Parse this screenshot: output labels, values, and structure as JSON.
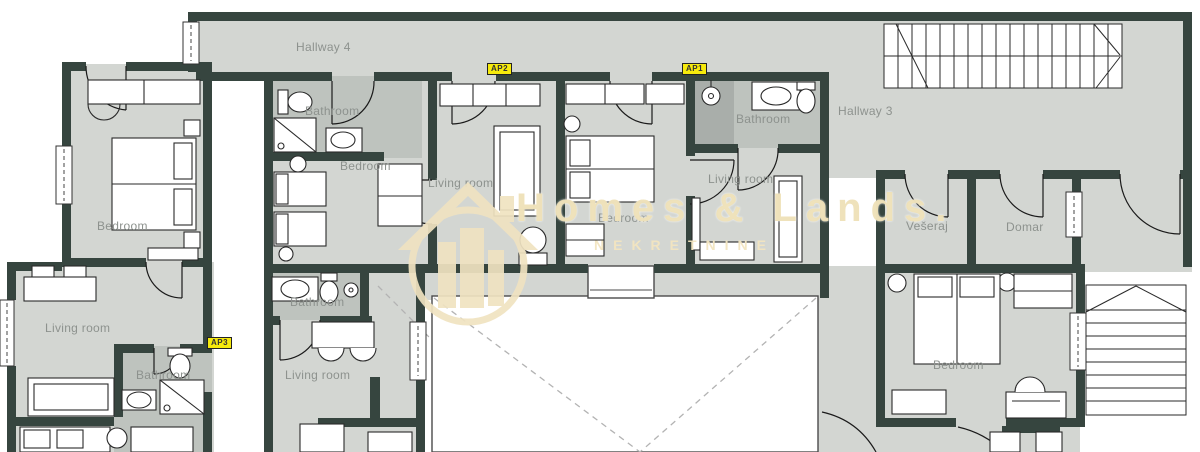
{
  "labels": {
    "hallway4": "Hallway 4",
    "hallway3": "Hallway 3",
    "bedroom_tl": "Bedroom",
    "bathroom_ap2_upper": "Bathroom",
    "bedroom_ap2": "Bedroom",
    "living_ap2": "Living room",
    "bedroom_ap1": "Bedroom",
    "bathroom_ap1": "Bathroom",
    "living_ap1": "Living room",
    "veseraj": "Vešeraj",
    "domar": "Domar",
    "bedroom_right": "Bedroom",
    "living_bl": "Living room",
    "bathroom_bl": "Bathroom",
    "bathroom_mid": "Bathroom",
    "living_mid": "Living room"
  },
  "badges": {
    "ap1": "AP1",
    "ap2": "AP2",
    "ap3": "AP3"
  },
  "watermark": {
    "title": "Homes & Lands.",
    "subtitle": "NEKRETNINE"
  },
  "colors": {
    "wall": "#36453f",
    "floor": "#d3d6d2",
    "bathroom_floor": "#bec3be",
    "shower_floor": "#a9aeaa",
    "badge_bg": "#f6ea0c",
    "label_text": "#8d928e",
    "watermark_beige": "#f0e3c1",
    "void_dash": "#b3b3b3"
  }
}
